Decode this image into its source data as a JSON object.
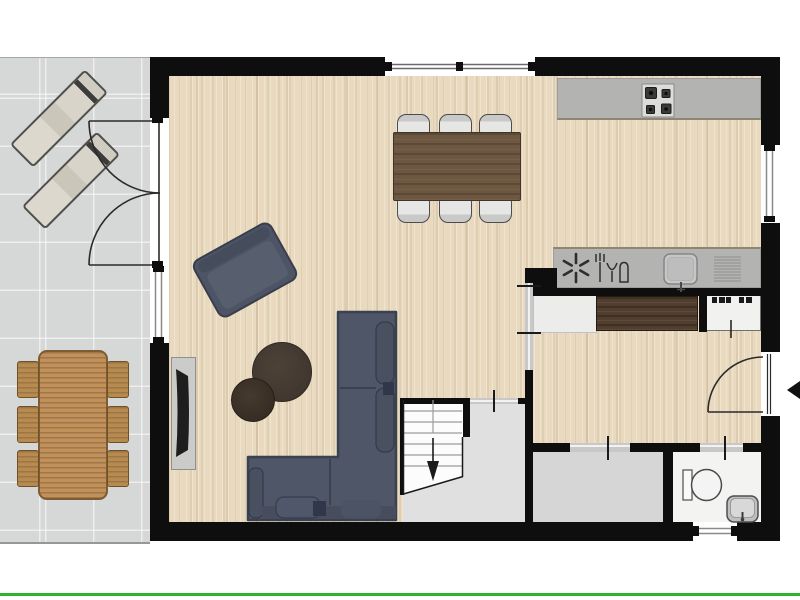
{
  "image_type": "2d-architectural-floor-plan",
  "colors": {
    "wall": "#0e0e0e",
    "wood": "#e8d9bf",
    "patio": "#d6d8d7",
    "counter": "#b3b4b2",
    "counterEdge": "#8d8670",
    "openingGray": "#c8c8c8",
    "sofa": "#4f5667",
    "sofaDark": "#3a4150",
    "sofaCushion": "#49505f",
    "armchair": "#4d5465",
    "coffeeTableLarge": "#473b31",
    "coffeeTableSmall": "#392f27",
    "diningTable": "#6d5741",
    "diningChair": "#d9d9d7",
    "outdoorWood": "#c2915a",
    "outdoorChair": "#b78a50",
    "lounger": "#d8d4c9",
    "tv": "#1e1e1e",
    "tvConsole": "#cbccca",
    "sideboard": "#513e2e",
    "grayRoom": "#dfe0df",
    "storage": "#d5d6d5",
    "bathroom": "#f3f3f1",
    "stairs": "#fcfcfc",
    "lineWork": "#2a2a2a",
    "green": "#2db32d"
  },
  "floor_plan": {
    "rooms": [
      {
        "id": "terrace",
        "floor": "gray-tile",
        "furniture": [
          "sun-lounger",
          "sun-lounger",
          "outdoor-dining-table",
          "outdoor-chair x6"
        ],
        "features": [
          "double-french-door-to-living-room"
        ]
      },
      {
        "id": "living-dining-kitchen",
        "floor": "light-wood-plank",
        "furniture": [
          "dining-table",
          "dining-chair x6",
          "kitchen-counter-with-hob",
          "kitchen-counter-with-sink-and-appliance-symbols",
          "corner-sofa",
          "armchair",
          "round-coffee-table-large",
          "round-coffee-table-small",
          "tv-console",
          "tv"
        ],
        "features": [
          "top-wall-window",
          "left-wall-window",
          "right-wall-window",
          "4-burner-hob",
          "extractor-fan-symbol",
          "dishwasher-symbol",
          "kitchen-sink",
          "drainer-grille"
        ]
      },
      {
        "id": "hallway",
        "floor": "light-wood-plank",
        "furniture": [
          "sideboard",
          "appliance-with-knobs",
          "low-cabinet"
        ],
        "features": [
          "front-door-swing",
          "entrance-arrow-left",
          "door-opening-to-living-room",
          "door-opening-to-storage",
          "door-opening-to-bathroom"
        ]
      },
      {
        "id": "stair-hall",
        "floor": "gray",
        "furniture": [
          "staircase"
        ],
        "features": [
          "stair-down-arrow",
          "door-opening-to-living-room"
        ]
      },
      {
        "id": "storage-room",
        "floor": "gray",
        "furniture": [],
        "features": []
      },
      {
        "id": "bathroom",
        "floor": "white",
        "furniture": [
          "toilet",
          "washbasin"
        ],
        "features": [
          "bottom-wall-window"
        ]
      }
    ],
    "annotations": {
      "entrance_arrow_direction": "left",
      "stair_arrow_direction": "down",
      "bottom_border": "green-line"
    }
  }
}
